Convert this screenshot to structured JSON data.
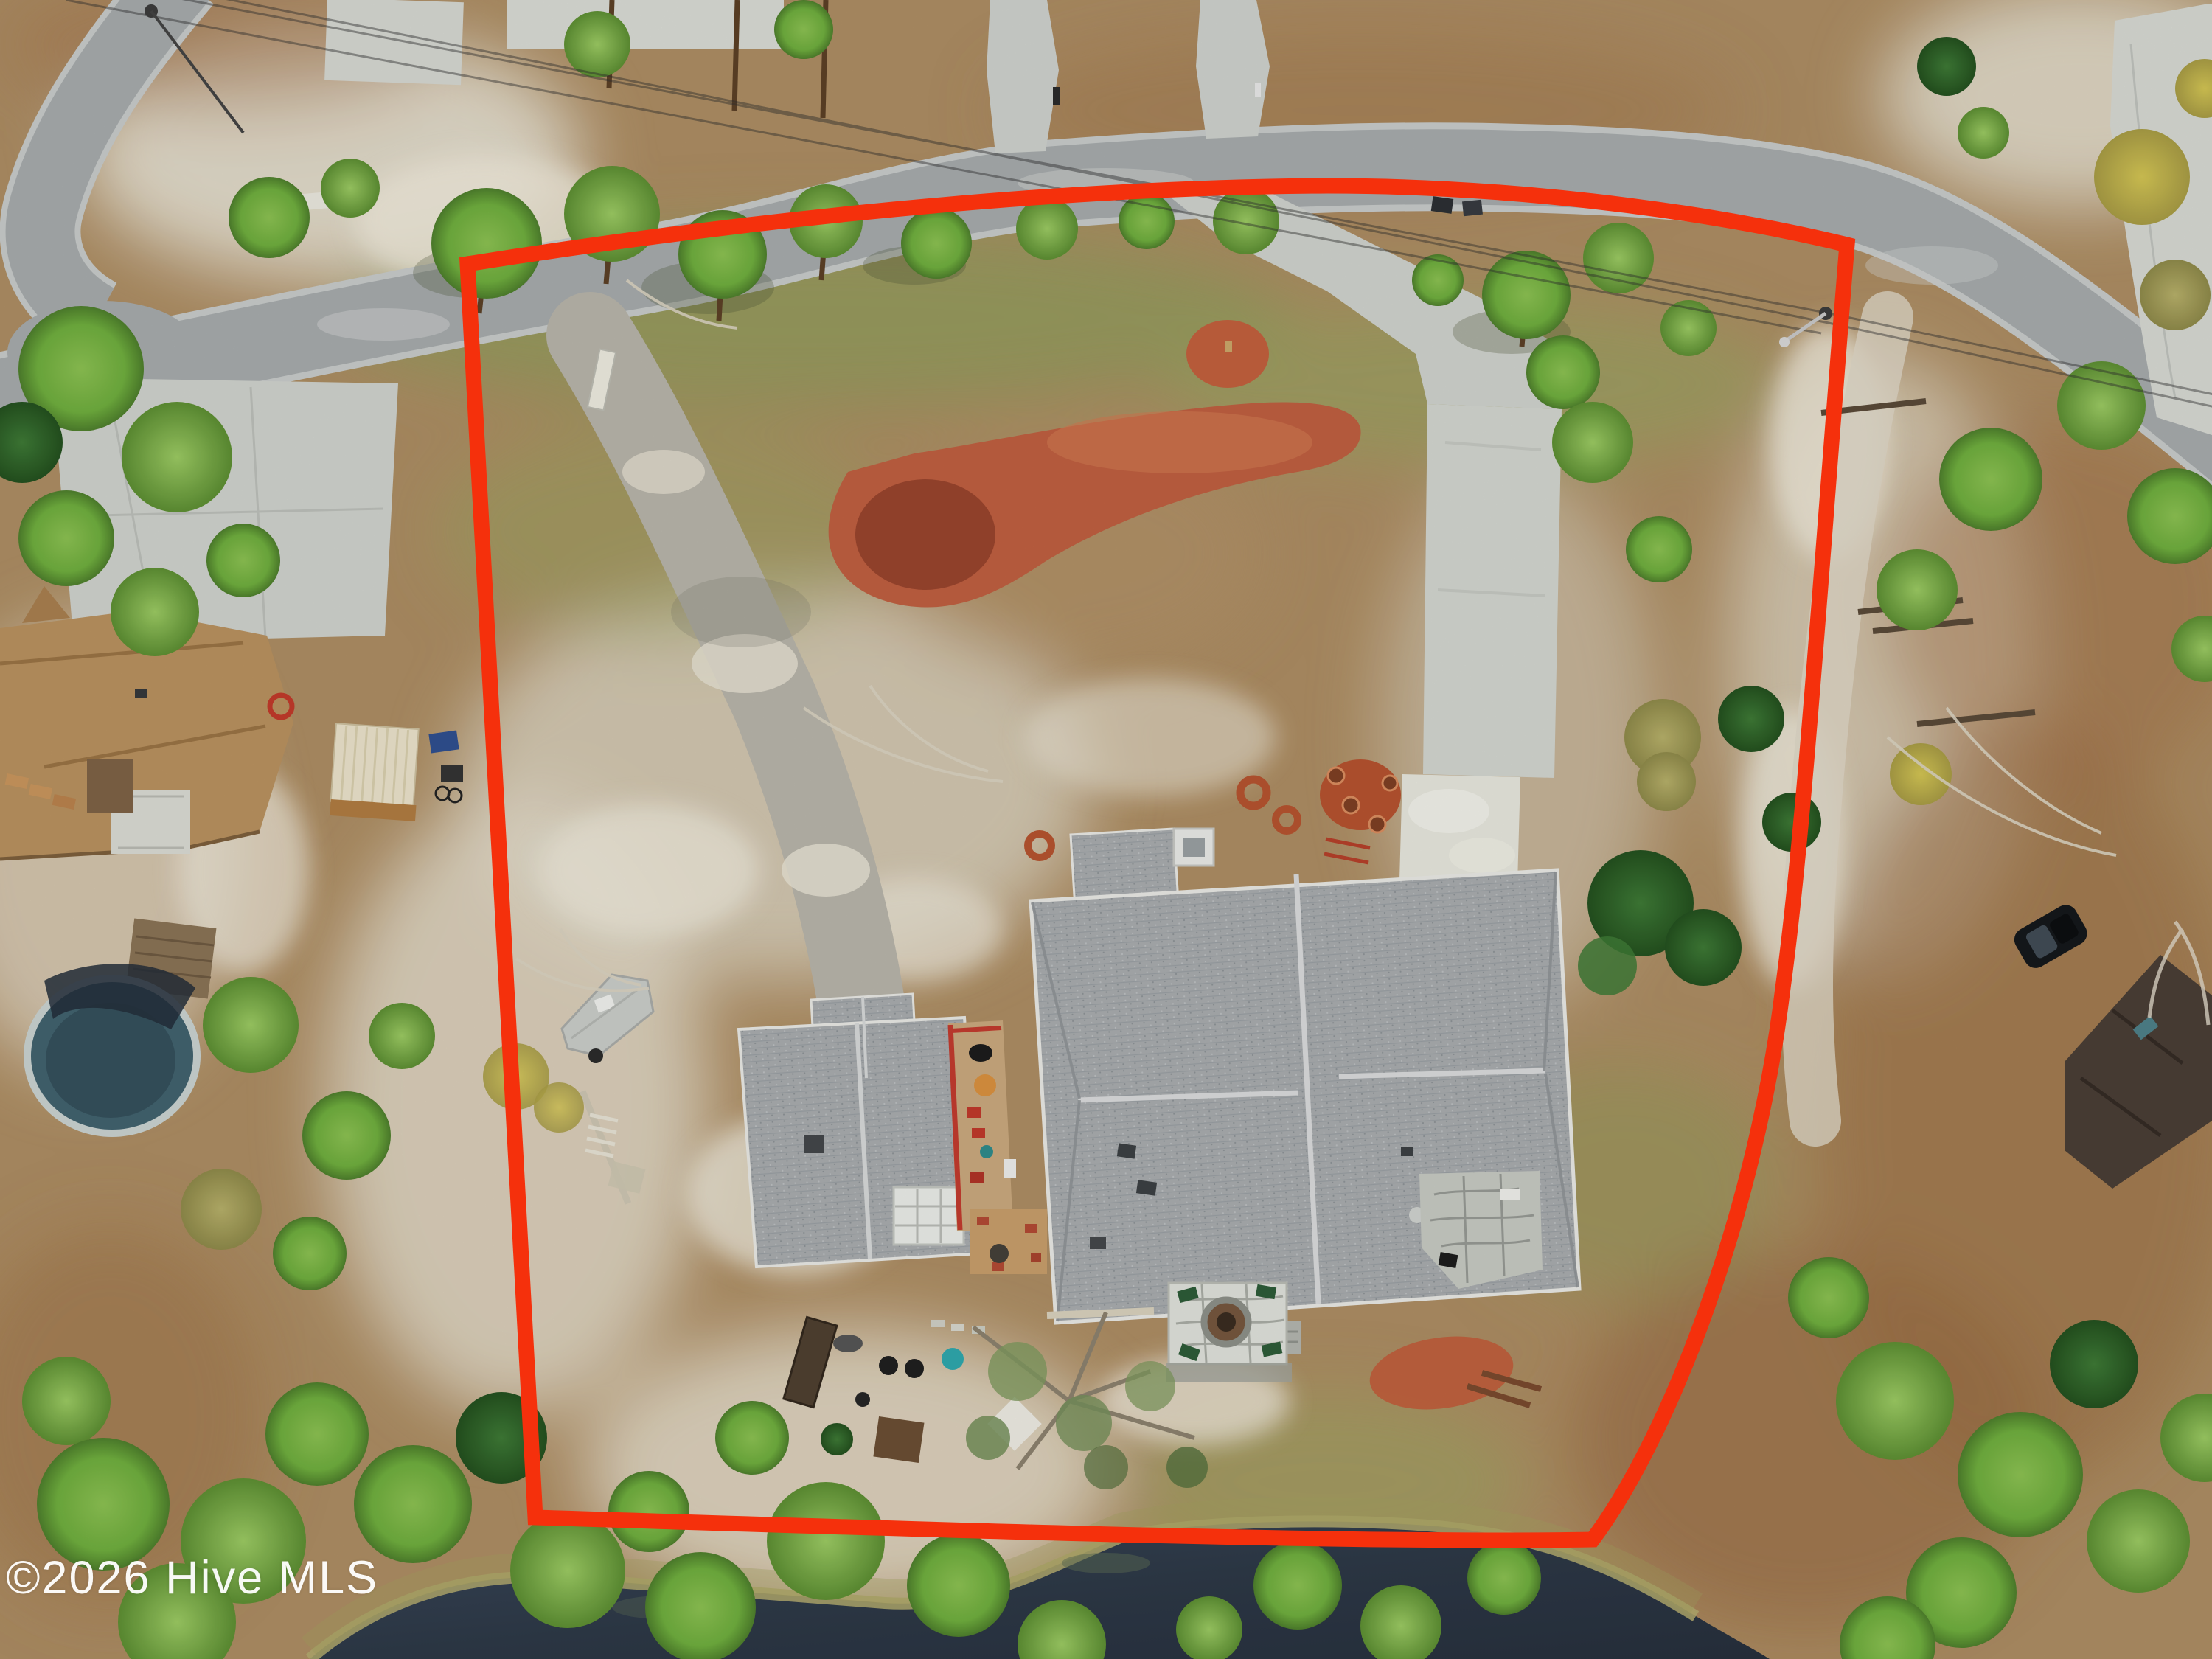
{
  "watermark": {
    "text": "©2026 Hive MLS",
    "color": "#ffffff"
  },
  "overlay": {
    "name": "property-boundary-outline",
    "color": "#f5300c",
    "shape": "rounded trapezoid outlining the listed lot"
  },
  "scene": {
    "description": "top-down aerial drone photo of a residential lot for sale",
    "features": [
      "curving asphalt street across the top with a side street at the top-left",
      "main house with gray hip shingle roof, white chimney and stone patio",
      "detached guest house / garage with gray roof and greenhouse panel",
      "wood deck with grill and red chairs between the buildings",
      "long concrete driveway from the street to the house",
      "gravel driveway on the left side of the lot",
      "large red mulch landscape bed near the street",
      "covered boat stored on the lawn",
      "stone fire-pit patio and vegetable garden near the pond",
      "dark pond along the bottom edge",
      "left neighbor: tan-roof house, above-ground pool, cream shed",
      "right neighbor: dark brown roof cabin with black parked car",
      "pine trees, khaki shrubs, white sand patches, power lines"
    ],
    "palette": {
      "ground_tan": "#ad8d63",
      "sand_white": "#e6e1d3",
      "grass_green": "#8a9e59",
      "pine_green": "#6fae3e",
      "pine_dark": "#2f6b2f",
      "straw_brown": "#9b6f46",
      "road_gray": "#a6abac",
      "concrete": "#d2d5cf",
      "roof_gray": "#a8acae",
      "neighbor_roof_tan": "#b8915f",
      "neighbor_roof_brown": "#4a3e36",
      "mulch_red": "#bf5f40",
      "water_dark": "#2d3947",
      "boundary_red": "#f5300c"
    }
  }
}
